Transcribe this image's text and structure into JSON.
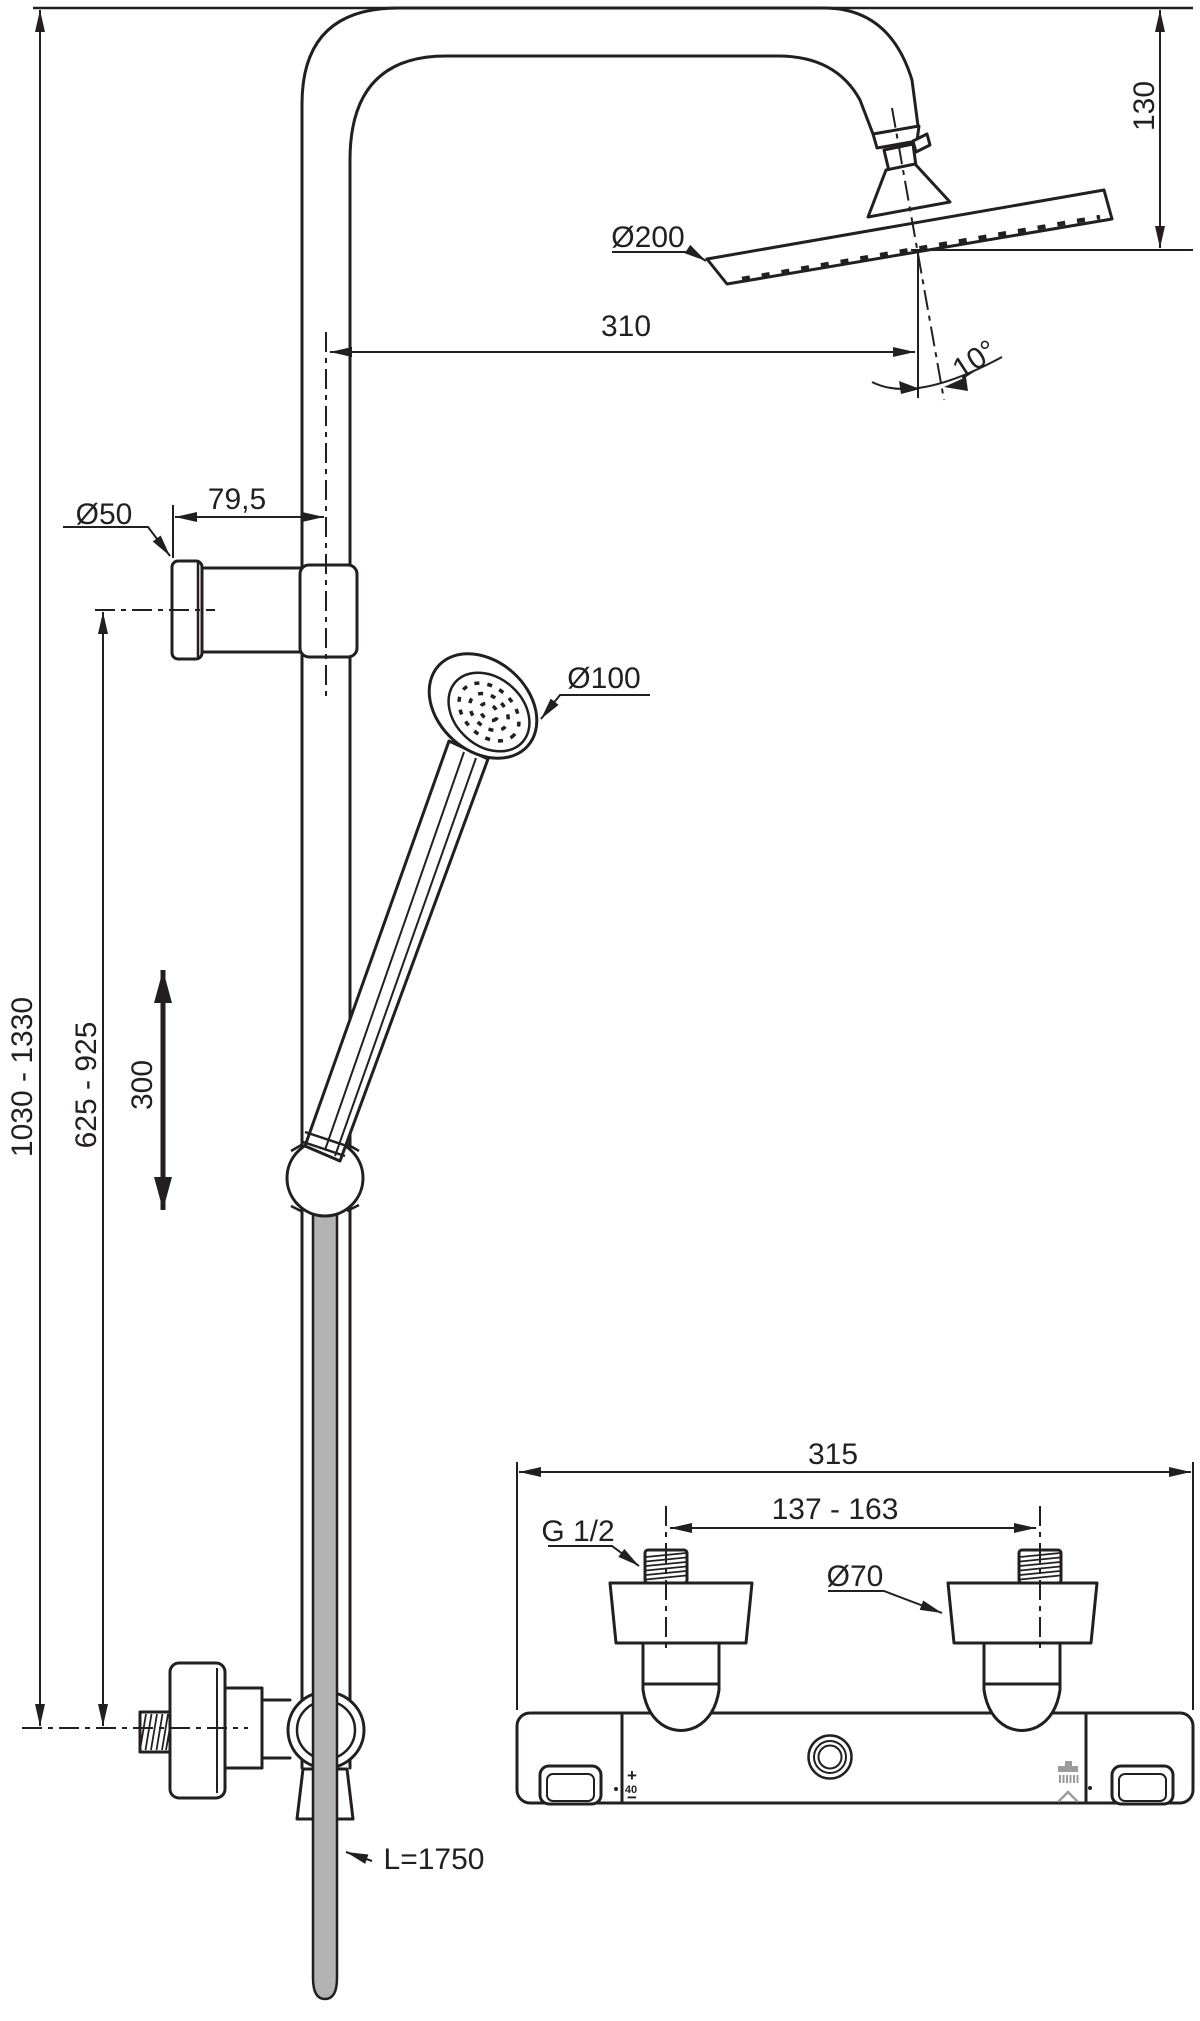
{
  "drawing": {
    "type": "technical-dimension-drawing",
    "subject": "shower system with overhead shower, hand shower, shower rail and thermostatic mixer",
    "colors": {
      "line": "#231f20",
      "hose_fill": "#b3b3b3",
      "icon_gray": "#9b9b9b",
      "background": "#ffffff"
    },
    "labels": {
      "head_drop": "130",
      "head_diameter": "Ø200",
      "arm_reach": "310",
      "head_angle": "10°",
      "bracket_diameter": "Ø50",
      "bracket_offset": "79,5",
      "hand_shower_diameter": "Ø100",
      "overall_height_range": "1030 - 1330",
      "hand_shower_height_range": "625 - 925",
      "slide_travel": "300",
      "mixer_width": "315",
      "inlet_spacing_range": "137 - 163",
      "inlet_thread": "G 1/2",
      "rosette_diameter": "Ø70",
      "hose_length": "L=1750",
      "mixer_plus": "+",
      "mixer_temp_stop": "40",
      "mixer_minus": "−"
    }
  }
}
